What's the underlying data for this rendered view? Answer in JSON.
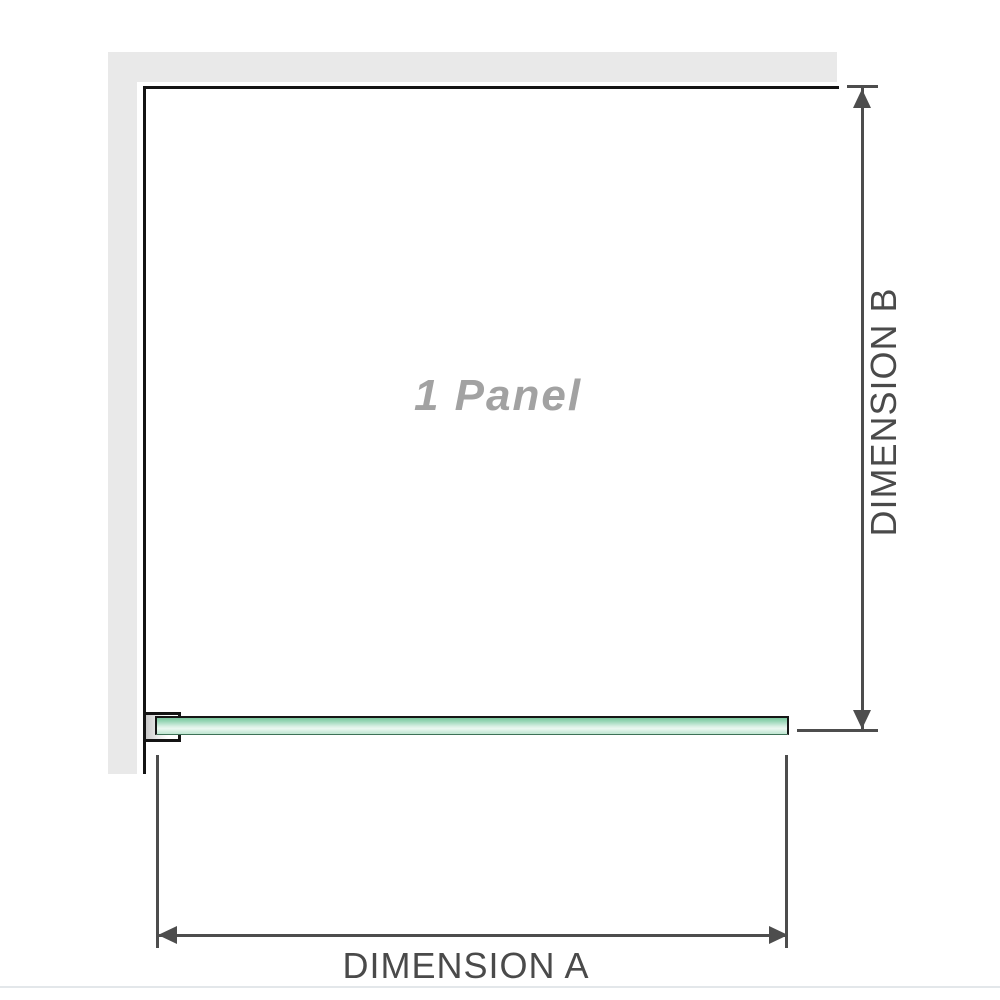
{
  "diagram": {
    "panel_label": "1 Panel",
    "dimension_a_label": "DIMENSION A",
    "dimension_b_label": "DIMENSION B"
  },
  "colors": {
    "wall_fill": "#e9e9e9",
    "wall_edge": "#141414",
    "glass_top": "#79c89e",
    "glass_mid": "#ecf8f1",
    "glass_bottom": "#bfe6d1",
    "dimension_line": "#4d4d4d",
    "label_text": "#4a4a4a",
    "panel_label_text": "#a2a2a2",
    "footer_rule": "#e3e7ea"
  }
}
